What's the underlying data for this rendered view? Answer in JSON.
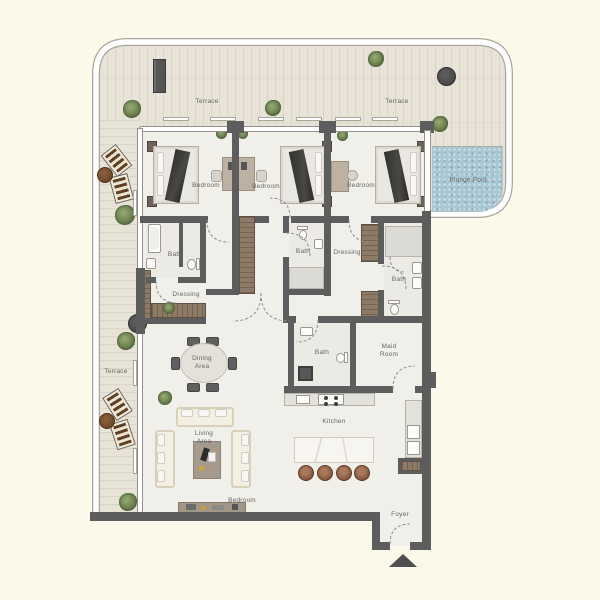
{
  "plan": {
    "title": "Apartment floor plan with wrap-around terrace and plunge pool",
    "terrace_labels": {
      "top_left": "Terrace",
      "top_right": "Terrace",
      "left": "Terrace"
    },
    "pool": {
      "label": "Plunge Pool"
    },
    "rooms": {
      "bedroom_1": "Bedroom",
      "bedroom_2": "Bedroom",
      "bedroom_3": "Bedroom",
      "bath_1": "Bath",
      "bath_2": "Bath",
      "bath_3": "Bath",
      "bath_4": "Bath",
      "dressing_1": "Dressing",
      "dressing_2": "Dressing",
      "maid_room": "Maid\nRoom",
      "dining_area": "Dining\nArea",
      "living_area": "Living\nArea",
      "kitchen": "Kitchen",
      "bedroom_living": "Bedroom",
      "foyer": "Foyer"
    },
    "colors": {
      "page_bg": "#fbf9e9",
      "terrace_floor": "#e8e3d7",
      "interior_floor": "#f1efe9",
      "wall": "#5d5d5d",
      "wood": "#8d7b68",
      "pool_water": "#a9c6d3",
      "plant_green": "#6d8150",
      "label_text": "#676662"
    }
  }
}
